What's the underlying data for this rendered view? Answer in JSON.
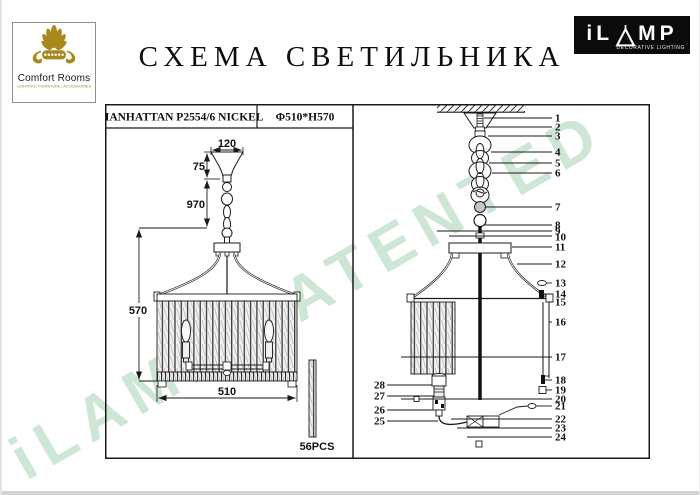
{
  "header": {
    "logo_comfort": {
      "name": "Comfort Rooms",
      "tagline": "LIGHTING | FURNITURE | ACCESSORIES"
    },
    "title": "СХЕМА СВЕТИЛЬНИКА",
    "logo_ilamp": {
      "letters_left": "iL",
      "letters_right": "MP",
      "tagline": "DECORATIVE LIGHTING"
    }
  },
  "table_header": {
    "model": "MANHATTAN P2554/6 NICKEL",
    "dimensions": "Φ510*H570"
  },
  "left_drawing": {
    "dim_canopy_width": "120",
    "dim_canopy_height": "75",
    "dim_chain_length": "970",
    "dim_body_height": "570",
    "dim_body_width": "510",
    "rod_count": "56PCS"
  },
  "right_drawing": {
    "parts_right": [
      "1",
      "2",
      "3",
      "4",
      "5",
      "6",
      "7",
      "8",
      "9",
      "10",
      "11",
      "12",
      "13",
      "14",
      "15",
      "16",
      "17",
      "18",
      "19",
      "20",
      "21",
      "22",
      "23",
      "24"
    ],
    "parts_left": [
      "25",
      "26",
      "27",
      "28"
    ]
  },
  "watermark": "iLAMP PATENTED",
  "colors": {
    "brand_gold": "#a8871c",
    "logo_bg": "#0b0b0b",
    "watermark_green": "#92c7a2",
    "line": "#1a1a1a"
  }
}
